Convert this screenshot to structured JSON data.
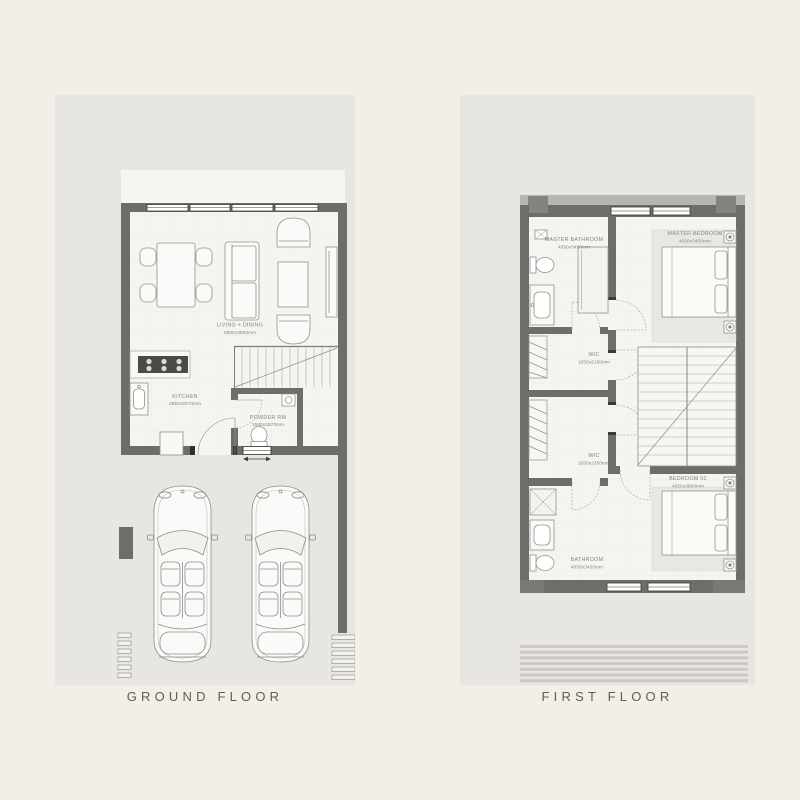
{
  "page": {
    "background": "#f2efe9"
  },
  "colors": {
    "panel": "#e8e6e1",
    "wall": "#6e6d68",
    "wall_accent": "#85837e",
    "floor": "#f5f4f0",
    "furniture_line": "#94928c",
    "label_text": "#86847b",
    "title_text": "#5c6155"
  },
  "floors": {
    "ground": {
      "title": "GROUND FLOOR",
      "rooms": {
        "living": {
          "name": "LIVING + DINING",
          "dims": "5800x3550mm"
        },
        "kitchen": {
          "name": "KITCHEN",
          "dims": "2950x2570mm"
        },
        "powder": {
          "name": "POWDER RM",
          "dims": "1580x2570mm"
        }
      }
    },
    "first": {
      "title": "FIRST FLOOR",
      "rooms": {
        "master_bathroom": {
          "name": "MASTER BATHROOM",
          "dims": "4050x3450mm"
        },
        "master_bedroom": {
          "name": "MASTER BEDROOM",
          "dims": "4050x3450mm"
        },
        "wic_upper": {
          "name": "WIC",
          "dims": "1650x2150mm"
        },
        "wic_lower": {
          "name": "WIC",
          "dims": "1650x2350mm"
        },
        "bathroom": {
          "name": "BATHROOM",
          "dims": "4050x3450mm"
        },
        "bedroom_02": {
          "name": "BEDROOM 02",
          "dims": "4050x3800mm"
        }
      }
    }
  }
}
